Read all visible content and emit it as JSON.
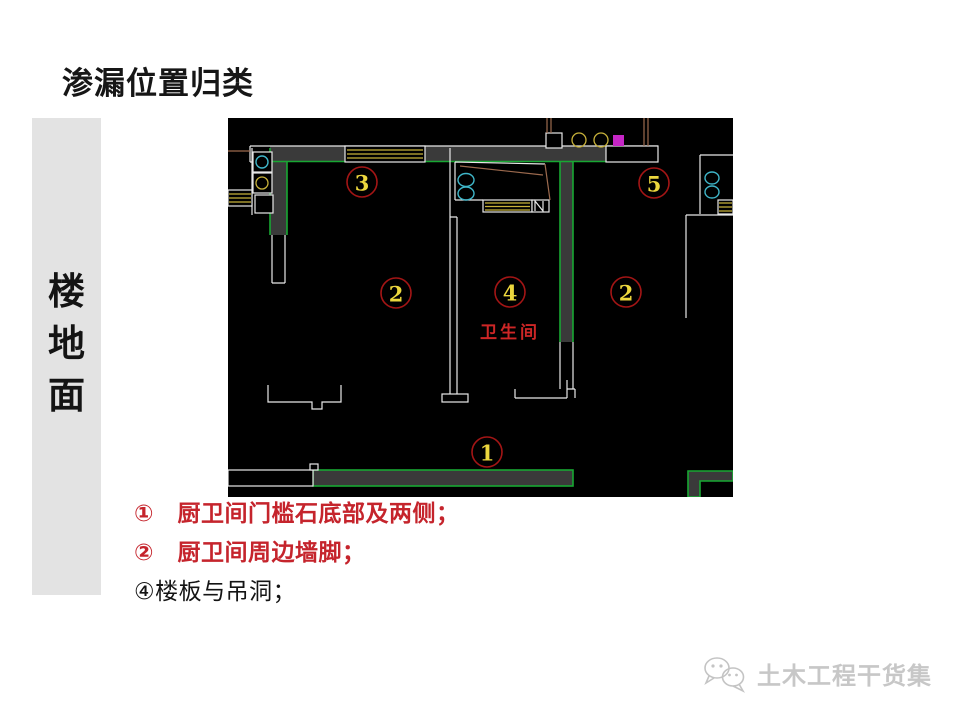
{
  "colors": {
    "plan-bg": "#000000",
    "wall-fill": "#3a3a3a",
    "wall-line": "#e8e8e8",
    "green": "#18a733",
    "yellow": "#c8b23a",
    "marker-yellow": "#ecd73e",
    "marker-red": "#a31515",
    "cyan": "#3fb6c9",
    "magenta": "#c626c6",
    "tan": "#9c6a4e",
    "label-red": "#cd2626",
    "sidebar-bg": "#e3e3e3",
    "watermark": "#c7c7c7",
    "text-dark": "#161616"
  },
  "slide": {
    "title": "渗漏位置归类",
    "sidebar_chars": [
      "楼",
      "地",
      "面"
    ],
    "bullets": [
      {
        "text": "①　厨卫间门槛石底部及两侧；",
        "color": "#c5242c",
        "weight": 700
      },
      {
        "text": "②　厨卫间周边墙脚；",
        "color": "#c5242c",
        "weight": 700
      },
      {
        "text": "④楼板与吊洞；",
        "color": "#141414",
        "weight": 500
      }
    ],
    "watermark_text": "土木工程干货集"
  },
  "floorplan": {
    "room_label": "卫生间",
    "markers": [
      {
        "label": "3",
        "x": 134,
        "y": 64
      },
      {
        "label": "5",
        "x": 426,
        "y": 65
      },
      {
        "label": "2",
        "x": 168,
        "y": 175
      },
      {
        "label": "4",
        "x": 282,
        "y": 174
      },
      {
        "label": "2",
        "x": 398,
        "y": 174
      },
      {
        "label": "1",
        "x": 259,
        "y": 334
      }
    ]
  }
}
